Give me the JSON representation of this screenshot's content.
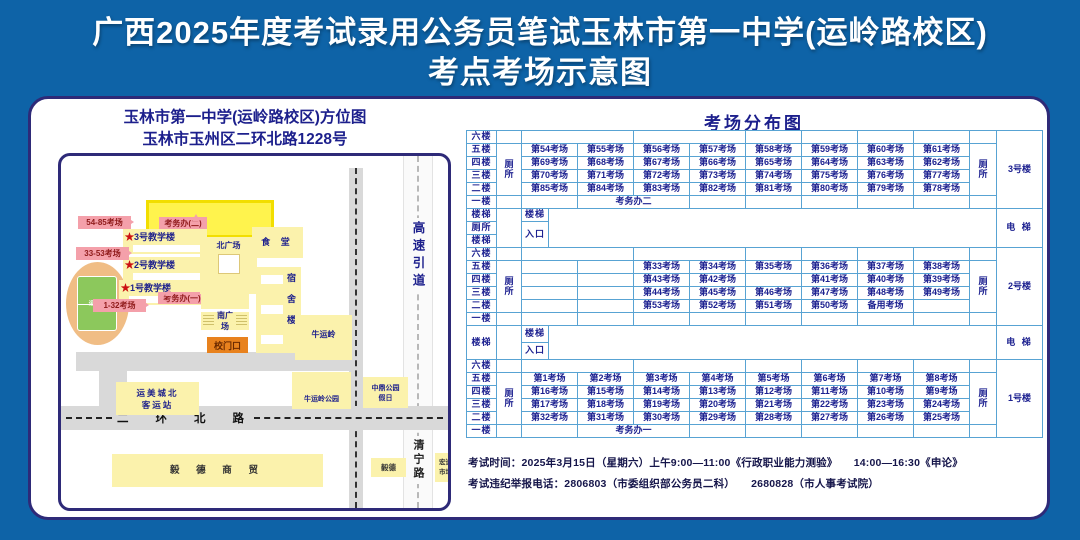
{
  "title": {
    "line1": "广西2025年度考试录用公务员笔试玉林市第一中学(运岭路校区)",
    "line2": "考点考场示意图"
  },
  "map": {
    "header": {
      "line1": "玉林市第一中学(运岭路校区)方位图",
      "line2": "玉林市玉州区二环北路1228号"
    },
    "admin_office_2": "考务办(二)",
    "admin_office_1": "考务办(一)",
    "tag_54_85": "54-85考场",
    "tag_33_53": "33-53考场",
    "tag_1_32": "1-32考场",
    "star": "★",
    "building3": "3号教学楼",
    "building2": "2号教学楼",
    "building1": "1号教学楼",
    "north_plaza": "北广场",
    "canteen": "食 堂",
    "dorm": "宿舍楼",
    "south_plaza": "南广场",
    "school_gate": "校门口",
    "playground": "运动场",
    "niuyunling": "牛运岭",
    "niuyunling_park": "牛运岭公园",
    "bus_station_l1": "运美城北",
    "bus_station_l2": "客运站",
    "zhongding_l1": "中鼎公园",
    "zhongding_l2": "假日",
    "erhuan_road": "二环北路",
    "yide_trade": "毅 德 商 贸",
    "yide": "毅德",
    "qingning_road": "清宁路",
    "hongjin_l1": "宏进",
    "hongjin_l2": "市场",
    "expressway": "高速引道"
  },
  "table": {
    "title": "考场分布图",
    "floors": [
      "六楼",
      "五楼",
      "四楼",
      "三楼",
      "二楼",
      "一楼"
    ],
    "wc": "厕所",
    "elevator": "电 梯",
    "stairA": {
      "left": [
        "楼梯",
        "厕所",
        "楼梯"
      ],
      "stair": "楼梯",
      "entrance": "入口"
    },
    "stairB": {
      "left": [
        "楼梯"
      ],
      "stair": "楼梯",
      "entrance": "入口"
    },
    "blocks": [
      {
        "name": "3号楼",
        "office": "考务办二",
        "rows": [
          [
            "第54考场",
            "第55考场",
            "第56考场",
            "第57考场",
            "第58考场",
            "第59考场",
            "第60考场",
            "第61考场"
          ],
          [
            "第69考场",
            "第68考场",
            "第67考场",
            "第66考场",
            "第65考场",
            "第64考场",
            "第63考场",
            "第62考场"
          ],
          [
            "第70考场",
            "第71考场",
            "第72考场",
            "第73考场",
            "第74考场",
            "第75考场",
            "第76考场",
            "第77考场"
          ],
          [
            "第85考场",
            "第84考场",
            "第83考场",
            "第82考场",
            "第81考场",
            "第80考场",
            "第79考场",
            "第78考场"
          ]
        ]
      },
      {
        "name": "2号楼",
        "office": "",
        "rows": [
          [
            "",
            "",
            "第33考场",
            "第34考场",
            "第35考场",
            "第36考场",
            "第37考场",
            "第38考场"
          ],
          [
            "",
            "",
            "第43考场",
            "第42考场",
            "",
            "第41考场",
            "第40考场",
            "第39考场"
          ],
          [
            "",
            "",
            "第44考场",
            "第45考场",
            "第46考场",
            "第47考场",
            "第48考场",
            "第49考场"
          ],
          [
            "",
            "",
            "第53考场",
            "第52考场",
            "第51考场",
            "第50考场",
            "备用考场",
            ""
          ]
        ]
      },
      {
        "name": "1号楼",
        "office": "考务办一",
        "rows": [
          [
            "第1考场",
            "第2考场",
            "第3考场",
            "第4考场",
            "第5考场",
            "第6考场",
            "第7考场",
            "第8考场"
          ],
          [
            "第16考场",
            "第15考场",
            "第14考场",
            "第13考场",
            "第12考场",
            "第11考场",
            "第10考场",
            "第9考场"
          ],
          [
            "第17考场",
            "第18考场",
            "第19考场",
            "第20考场",
            "第21考场",
            "第22考场",
            "第23考场",
            "第24考场"
          ],
          [
            "第32考场",
            "第31考场",
            "第30考场",
            "第29考场",
            "第28考场",
            "第27考场",
            "第26考场",
            "第25考场"
          ]
        ]
      }
    ]
  },
  "footer": {
    "line1": "考试时间：2025年3月15日（星期六）上午9:00—11:00《行政职业能力测验》　　14:00—16:30《申论》",
    "line2": "考试违纪举报电话：2806803（市委组织部公务员二科）　　2680828（市人事考试院）"
  }
}
